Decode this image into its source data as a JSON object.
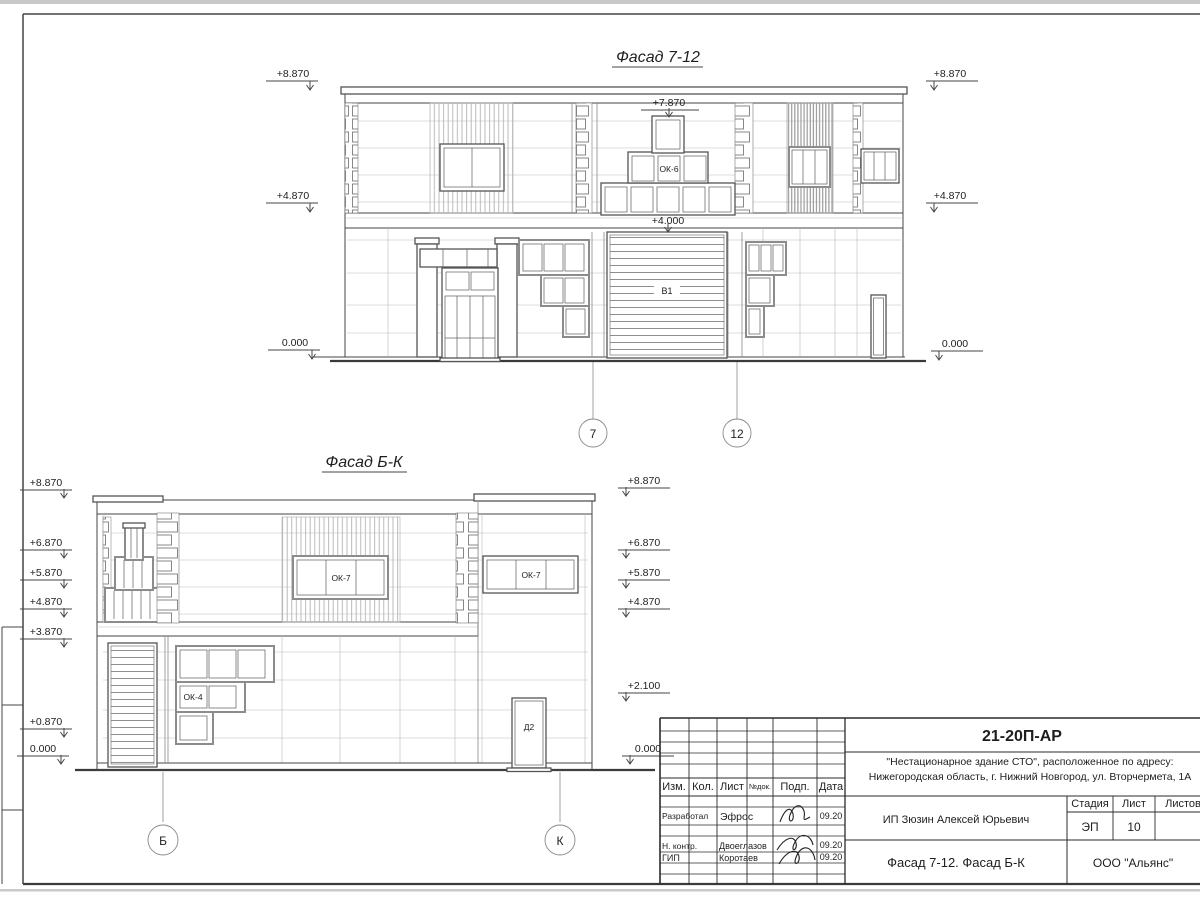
{
  "facade_top": {
    "title": "Фасад 7-12",
    "marks_left": [
      "+8.870",
      "+4.870",
      "0.000"
    ],
    "marks_right": [
      "+8.870",
      "+4.870",
      "0.000"
    ],
    "mark_ok6_top": "+7.870",
    "mark_gate_top": "+4.000",
    "window_label": "ОК-6",
    "gate_label": "В1",
    "axis_left": "7",
    "axis_right": "12"
  },
  "facade_bottom": {
    "title": "Фасад Б-К",
    "marks_left": [
      "+8.870",
      "+6.870",
      "+5.870",
      "+4.870",
      "+3.870",
      "+0.870",
      "0.000"
    ],
    "marks_right": [
      "+8.870",
      "+6.870",
      "+5.870",
      "+4.870",
      "+2.100",
      "0.000"
    ],
    "window_label_1": "ОК-7",
    "window_label_2": "ОК-7",
    "window_label_3": "ОК-4",
    "door_label": "Д2",
    "axis_left": "Б",
    "axis_right": "К"
  },
  "title_block": {
    "doc_code": "21-20П-АР",
    "address_line1": "\"Нестационарное здание СТО\", расположенное по адресу:",
    "address_line2": "Нижегородская область, г. Нижний Новгород, ул. Вторчермета, 1А",
    "columns": {
      "izm": "Изм.",
      "kol": "Кол.",
      "list": "Лист",
      "ndoc": "№док.",
      "podp": "Подп.",
      "data": "Дата"
    },
    "rows": [
      {
        "role": "Разработал",
        "name": "Эфрос",
        "date": "09.20"
      },
      {
        "role": "Н. контр.",
        "name": "Двоеглазов",
        "date": "09.20"
      },
      {
        "role": "ГИП",
        "name": "Коротаев",
        "date": "09.20"
      }
    ],
    "client": "ИП Зюзин Алексей Юрьевич",
    "stage_label": "Стадия",
    "sheet_label": "Лист",
    "sheets_label": "Листов",
    "stage": "ЭП",
    "sheet_number": "10",
    "sheet_title": "Фасад 7-12. Фасад Б-К",
    "company": "ООО \"Альянс\""
  }
}
